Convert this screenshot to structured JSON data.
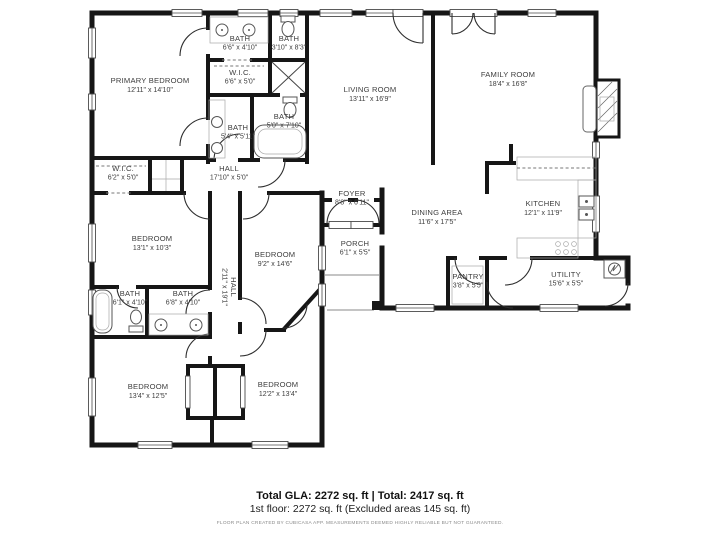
{
  "colors": {
    "wall": "#161616",
    "label": "#3d3d3d"
  },
  "rooms": [
    {
      "name": "PRIMARY BEDROOM",
      "dims": "12'11\" x 14'10\""
    },
    {
      "name": "BATH",
      "dims": "6'6\" x 4'10\""
    },
    {
      "name": "BATH",
      "dims": "3'10\" x 8'3\""
    },
    {
      "name": "W.I.C.",
      "dims": "6'6\" x 5'0\""
    },
    {
      "name": "BATH",
      "dims": "5'4\" x 5'11\""
    },
    {
      "name": "BATH",
      "dims": "5'0\" x 7'10\""
    },
    {
      "name": "W.I.C.",
      "dims": "6'2\" x 5'0\""
    },
    {
      "name": "HALL",
      "dims": "17'10\" x 5'0\""
    },
    {
      "name": "LIVING ROOM",
      "dims": "13'11\" x 16'9\""
    },
    {
      "name": "FAMILY ROOM",
      "dims": "18'4\" x 16'8\""
    },
    {
      "name": "DINING AREA",
      "dims": "11'6\" x 17'5\""
    },
    {
      "name": "KITCHEN",
      "dims": "12'1\" x 11'9\""
    },
    {
      "name": "FOYER",
      "dims": "8'8\" x 6'11\""
    },
    {
      "name": "PORCH",
      "dims": "6'1\" x 5'5\""
    },
    {
      "name": "PANTRY",
      "dims": "3'8\" x 5'5\""
    },
    {
      "name": "UTILITY",
      "dims": "15'6\" x 5'5\""
    },
    {
      "name": "BEDROOM",
      "dims": "13'1\" x 10'3\""
    },
    {
      "name": "BEDROOM",
      "dims": "9'2\" x 14'6\""
    },
    {
      "name": "HALL",
      "dims": "2'11\" x 19'1\""
    },
    {
      "name": "BATH",
      "dims": "6'1\" x 4'10\""
    },
    {
      "name": "BATH",
      "dims": "6'8\" x 4'10\""
    },
    {
      "name": "BEDROOM",
      "dims": "13'4\" x 12'5\""
    },
    {
      "name": "BEDROOM",
      "dims": "12'2\" x 13'4\""
    }
  ],
  "footer": {
    "totals_line": "Total GLA: 2272 sq. ft | Total: 2417 sq. ft",
    "floor_line": "1st floor: 2272 sq. ft (Excluded areas 145 sq. ft)",
    "disclaimer": "FLOOR PLAN CREATED BY CUBICASA APP. MEASUREMENTS DEEMED HIGHLY RELIABLE BUT NOT GUARANTEED."
  }
}
